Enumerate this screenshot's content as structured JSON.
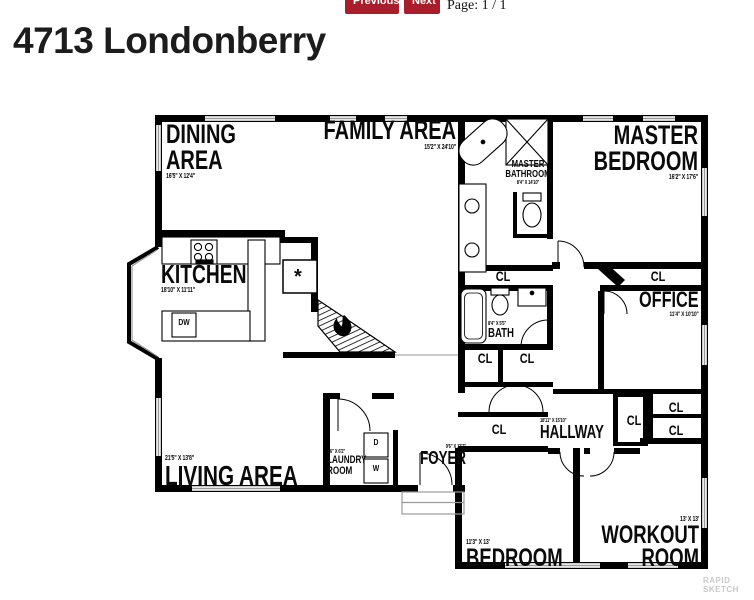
{
  "toolbar": {
    "previous_label": "Previous",
    "next_label": "Next",
    "page_label": "Page: 1 / 1",
    "button_color": "#a81e2b"
  },
  "header": {
    "title": "4713 Londonberry"
  },
  "floorplan": {
    "rooms": {
      "dining": {
        "name": "DINING AREA",
        "dims": "16'5\" X 12'4\""
      },
      "family": {
        "name": "FAMILY AREA",
        "dims": "15'2\" X 24'10\""
      },
      "master_bedroom": {
        "name": "MASTER BEDROOM",
        "dims": "16'2\" X 17'6\""
      },
      "master_bathroom": {
        "name": "MASTER BATHROOM",
        "dims": "8'4\" X 14'10\""
      },
      "kitchen": {
        "name": "KITCHEN",
        "dims": "18'10\" X 11'11\""
      },
      "office": {
        "name": "OFFICE",
        "dims": "11'4\" X 10'10\""
      },
      "bath": {
        "name": "BATH",
        "dims": "8'4\" X 5'5\""
      },
      "living": {
        "name": "LIVING AREA",
        "dims": "21'5\" X 13'8\""
      },
      "laundry": {
        "name": "LAUNDRY ROOM",
        "dims": "4'6\" X 6'2\""
      },
      "foyer": {
        "name": "FOYER",
        "dims": "9'6\" X 13'7\""
      },
      "hallway": {
        "name": "HALLWAY",
        "dims": "18'11\" X 15'10\""
      },
      "bedroom": {
        "name": "BEDROOM",
        "dims": "11'3\" X 13'"
      },
      "workout": {
        "name": "WORKOUT ROOM",
        "dims": "13' X 13'"
      }
    },
    "closet_label": "CL",
    "appliances": {
      "dishwasher": "DW",
      "dryer": "D",
      "washer": "W",
      "fireplace_marker": "*"
    },
    "colors": {
      "wall": "#000000",
      "window": "#9a9a9a"
    }
  },
  "watermark": {
    "line1": "RAPID",
    "line2": "SKETCH"
  }
}
